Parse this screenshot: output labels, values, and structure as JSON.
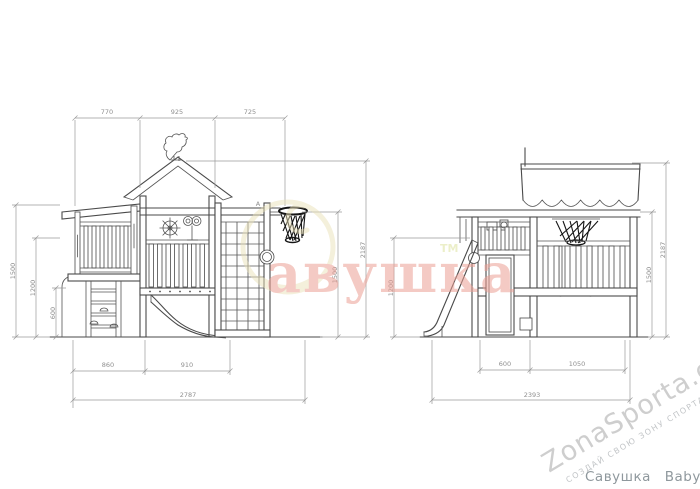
{
  "colors": {
    "line": "#4a4a4a",
    "dimension": "#9a9a9a",
    "brand_pink": "#ec9f94",
    "brand_gold": "#eae1b8",
    "tm_green": "#dde29e",
    "watermark_gray": "#c9c9c9",
    "caption_gray": "#8f989d",
    "net_black": "#161616"
  },
  "front_view": {
    "marker": "A",
    "dim_top": [
      "770",
      "925",
      "725"
    ],
    "dim_left_roof": "1500",
    "dim_left_platform": "1200",
    "dim_left_fence": "600",
    "dim_ring_height": "1500",
    "dim_total_height": "2187",
    "dim_bottom": [
      "860",
      "910"
    ],
    "dim_total_width": "2787"
  },
  "side_view": {
    "dim_platform_height": "1200",
    "dim_bottom": [
      "600",
      "1050"
    ],
    "dim_total_depth": "2393",
    "dim_ring_height": "1500",
    "dim_total_height": "2187"
  },
  "watermarks": {
    "brand": "авушка",
    "brand_tm": "ТМ",
    "site": "ZonaSporta.com",
    "slogan": "СОЗДАЙ СВОЮ ЗОНУ СПОРТА"
  },
  "caption": {
    "title": "Савушка Baby 7"
  }
}
